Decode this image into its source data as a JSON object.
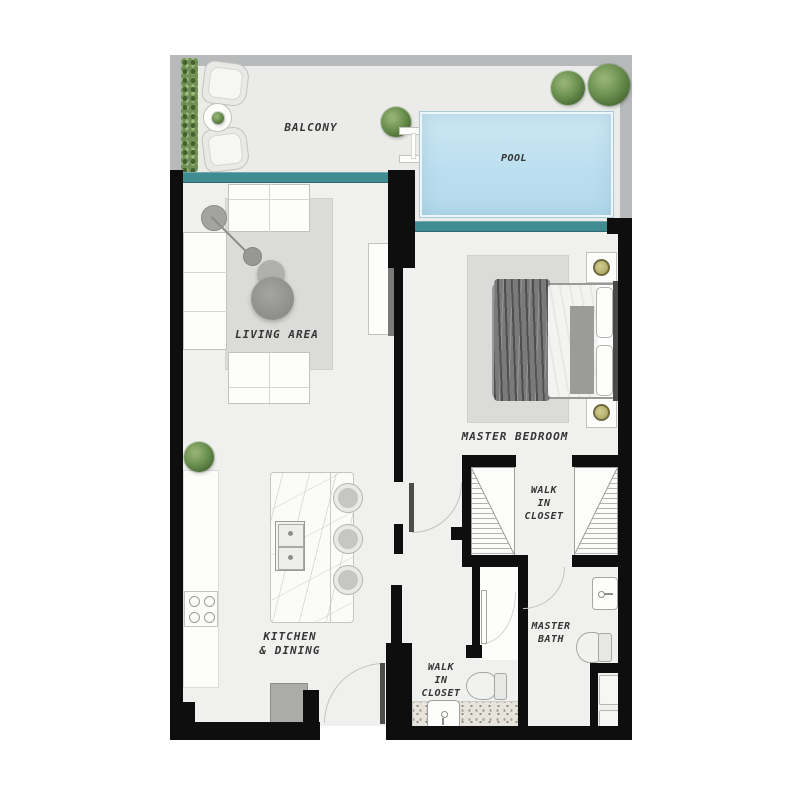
{
  "floor_plan": {
    "labels": {
      "balcony": "BALCONY",
      "pool": "POOL",
      "living_area": "LIVING AREA",
      "kitchen_line1": "KITCHEN",
      "kitchen_line2": "& DINING",
      "master_bedroom": "MASTER BEDROOM",
      "closet_upper_line1": "WALK",
      "closet_upper_line2": "IN",
      "closet_upper_line3": "CLOSET",
      "closet_lower_line1": "WALK",
      "closet_lower_line2": "IN",
      "closet_lower_line3": "CLOSET",
      "master_bath_line1": "MASTER",
      "master_bath_line2": "BATH"
    },
    "colors": {
      "wall": "#0e0e0e",
      "outer_wall": "#b7b9ba",
      "floor": "#f0f0ee",
      "balcony_floor": "#ebecea",
      "teal_accent": "#3f8d92",
      "pool_water": "#bcdff0",
      "rug": "#dbdbd9",
      "greenery": "#6f9155",
      "label_text": "#353535"
    },
    "furniture": {
      "balcony": [
        "hedge",
        "armchair",
        "armchair",
        "side-table",
        "tree",
        "pool-ladder",
        "tree",
        "tree"
      ],
      "living_area": [
        "tv-console",
        "tv",
        "rug",
        "sofa",
        "sofa",
        "chaise",
        "arc-lamp",
        "pouf-plant"
      ],
      "kitchen": [
        "counter",
        "stove",
        "island-marble",
        "double-sink",
        "stool",
        "stool",
        "stool",
        "fridge",
        "plant"
      ],
      "master_bedroom": [
        "rug",
        "bed",
        "pillows",
        "nightstand-lamp",
        "nightstand-lamp"
      ],
      "walk_in_closet_upper": [
        "wardrobe-hatched",
        "wardrobe-hatched"
      ],
      "master_bath": [
        "sink",
        "toilet",
        "shower-tray",
        "shower-tray"
      ],
      "walk_in_closet_lower": [
        "toilet",
        "vanity-sink",
        "speckled-counter"
      ]
    }
  }
}
